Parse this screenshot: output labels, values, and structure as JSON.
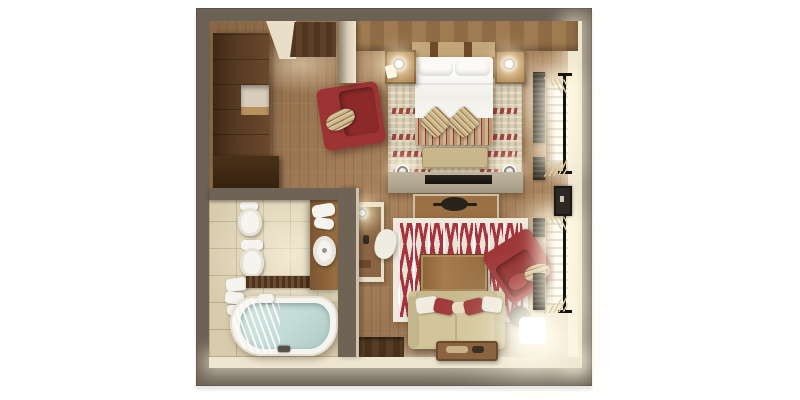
{
  "scene": {
    "kind": "3d-floor-plan-top-view",
    "setting": "studio suite with combined bedroom and living area, dressing area and bathroom",
    "background": "#ffffff"
  },
  "rooms": [
    {
      "name": "dressing-area",
      "objects": [
        "walnut-wardrobe",
        "wardrobe-open-shelf",
        "wardrobe-base-cabinet",
        "wood-plank-floor",
        "dark-entry-mat",
        "ceiling-soffit"
      ]
    },
    {
      "name": "bathroom",
      "objects": [
        "bidet",
        "toilet",
        "towel-shelf",
        "mosaic-floor-band",
        "corner-bathtub-with-glass-screen",
        "bath-faucet",
        "wood-vanity",
        "basin",
        "vanity-towels"
      ]
    },
    {
      "name": "bedroom",
      "objects": [
        "double-bed",
        "headboard",
        "white-pillows",
        "striped-bed-runner",
        "striped-accent-pillows",
        "foot-bench",
        "nightstand-left",
        "nightstand-right",
        "bedside-lamp-left",
        "bedside-lamp-right",
        "patterned-area-rug",
        "red-armchair",
        "ceiling-spotlight-left",
        "ceiling-spotlight-right",
        "tv-console",
        "tv-screen",
        "media-table",
        "decor-bowl"
      ]
    },
    {
      "name": "living-area",
      "objects": [
        "red-damask-rug",
        "wood-coffee-table",
        "cream-sofa",
        "sofa-throw-pillows",
        "red-armchair",
        "glowing-floor-lamp",
        "round-side-table",
        "wall-shelf-unit",
        "shelf-lamp",
        "floor-pouf",
        "serving-tray",
        "entry-floor-recess"
      ]
    }
  ],
  "windows": {
    "count": 2,
    "wall": "right",
    "features": [
      "daylight-glow",
      "venetian-slats",
      "dark-curtain-panels",
      "curtain-rod-with-finials",
      "tied-sheer-curtains",
      "wall-panel-between-windows"
    ]
  },
  "palette": {
    "wall_outer": "#6b6155",
    "wall_inner": "#efe6d0",
    "floor_wood": "#a6805a",
    "floor_wood_dark": "#7b5c3e",
    "wardrobe_wood": "#533620",
    "tile": "#d9ccae",
    "fixture_white": "#f6f4ee",
    "water": "#c3dbd6",
    "accent_red": "#9c3434",
    "accent_red_dark": "#8c2a2a",
    "damask_red": "#a53440",
    "rug_beige": "#d9d0b5",
    "rug_white": "#efeadd",
    "sofa_cream": "#cfc299",
    "wood_mid": "#9a7044",
    "console_greige": "#b2a791",
    "dark_fixture": "#282318",
    "glow_warm": "#fff3d6",
    "headboard_tan": "#c2a679"
  }
}
